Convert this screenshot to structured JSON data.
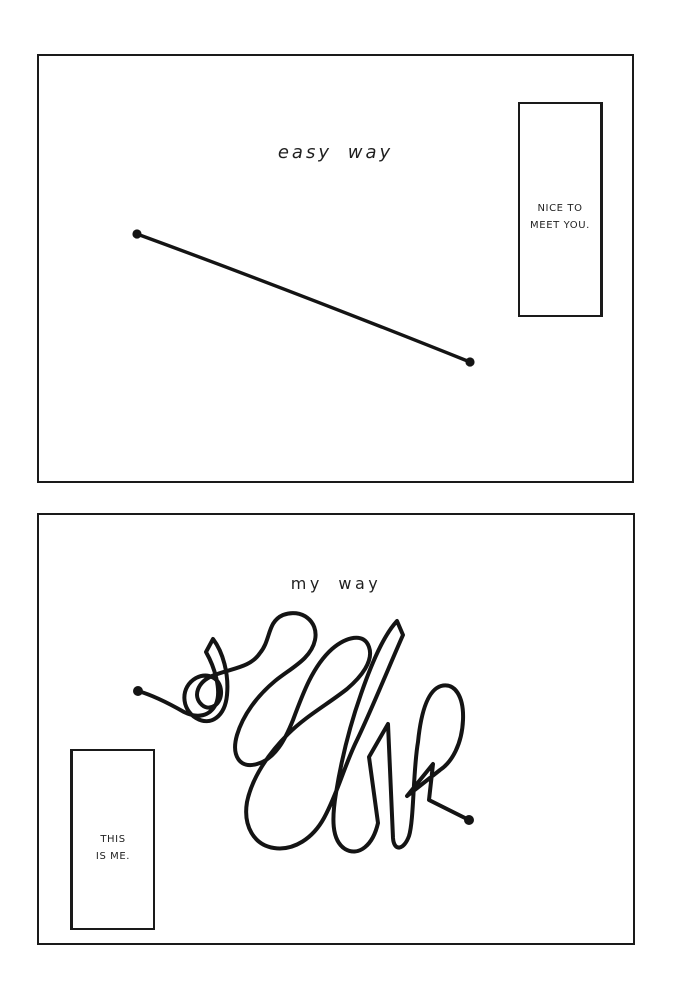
{
  "page": {
    "background_color": "#ffffff",
    "ink_color": "#141414",
    "description": "two-panel hand-drawn comic comparing paths between two points"
  },
  "panels": [
    {
      "id": "top",
      "title": "easy way",
      "speech_box": {
        "line1": "NICE TO",
        "line2": "MEET YOU."
      },
      "drawing": "straight line connecting two endpoint dots"
    },
    {
      "id": "bottom",
      "title": "my way",
      "speech_box": {
        "line1": "THIS",
        "line2": "IS ME."
      },
      "drawing": "tangled scribble line connecting two endpoint dots"
    }
  ]
}
